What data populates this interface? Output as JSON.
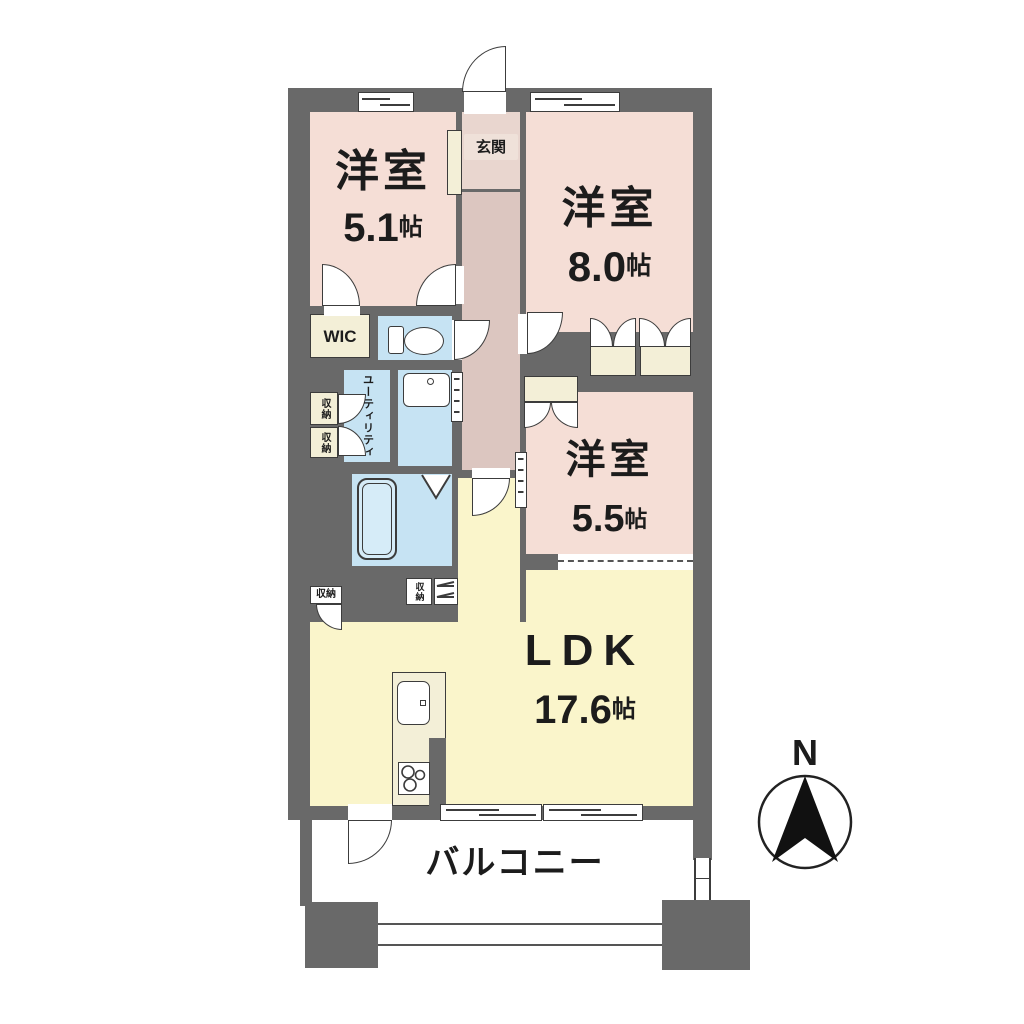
{
  "plan": {
    "rooms": {
      "bedroom_5_1": {
        "name": "洋室",
        "size_num": "5.1",
        "size_unit": "帖"
      },
      "bedroom_8_0": {
        "name": "洋室",
        "size_num": "8.0",
        "size_unit": "帖"
      },
      "bedroom_5_5": {
        "name": "洋室",
        "size_num": "5.5",
        "size_unit": "帖"
      },
      "ldk": {
        "name": "LDK",
        "size_num": "17.6",
        "size_unit": "帖"
      },
      "balcony": {
        "name": "バルコニー"
      },
      "entrance": {
        "name": "玄関"
      },
      "wic": {
        "name": "WIC"
      },
      "utility": {
        "name": "ユーティリティ"
      }
    },
    "storage": {
      "left_upper": "収納",
      "left_lower": "収納",
      "ldk_left": "収納",
      "ldk_mid": "収納"
    },
    "compass": {
      "north_label": "N"
    },
    "colors": {
      "wall": "#696969",
      "bedroom": "#f5ded6",
      "hall": "#dcc6c0",
      "entrance": "#e9d6cf",
      "wet_area": "#c6e3f3",
      "bathtub": "#d6ecf8",
      "ldk": "#faf5cb",
      "closet": "#f3efd7",
      "line": "#3c3c3c"
    }
  }
}
